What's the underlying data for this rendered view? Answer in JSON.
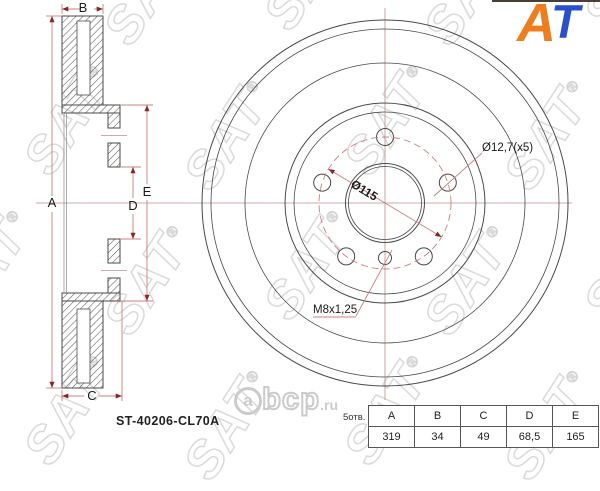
{
  "logo": {
    "part1": "A",
    "part2": "T",
    "color_a": "#ee7d1e",
    "color_t": "#2b50cc"
  },
  "watermark": {
    "text": "SAT",
    "registered": "®",
    "brand_bottom": {
      "a": "a",
      "rest": "bcp",
      "tld": ".ru"
    }
  },
  "drawing": {
    "part_number": "ST-40206-CL70A",
    "labels": {
      "dim_a": "A",
      "dim_b": "B",
      "dim_c": "C",
      "dim_d": "D",
      "dim_e": "E",
      "bolt_circle_diameter": "Ø115",
      "bolt_hole_diameter": "Ø12,7(x5)",
      "thread": "M8x1,25",
      "holes_note": "5отв."
    }
  },
  "spec_table": {
    "headers": [
      "A",
      "B",
      "C",
      "D",
      "E"
    ],
    "values": [
      "319",
      "34",
      "49",
      "68,5",
      "165"
    ]
  },
  "colors": {
    "line": "#4a4a4a",
    "dimension": "#cc7f7f",
    "arrow": "#8a2525",
    "centerline": "#bb8f8f",
    "watermark": "#dadada"
  }
}
